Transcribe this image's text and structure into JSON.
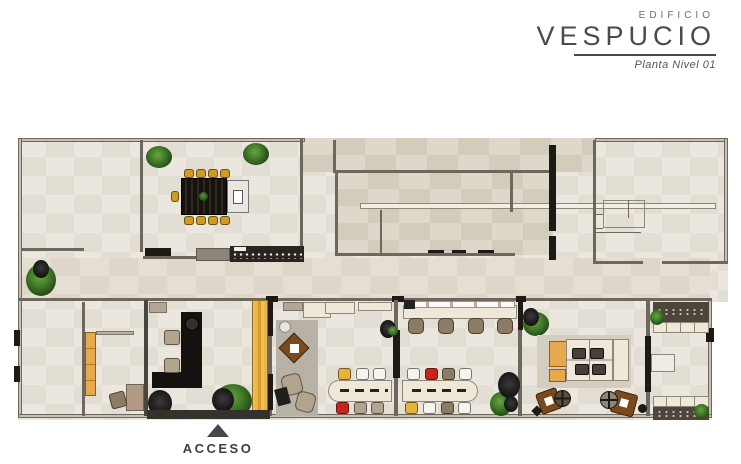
{
  "header": {
    "building_label": "EDIFICIO",
    "building_name": "VESPUCIO",
    "subtitle": "Planta Nivel 01"
  },
  "plan": {
    "access_label": "ACCESO"
  },
  "icons": {
    "access_arrow": "triangle-up-icon",
    "plant": "plant-icon"
  },
  "colors": {
    "floor": "#eae6dd",
    "floorAlt": "#dcd6c7",
    "floorMid": "#e3ddd0",
    "wallFill": "#c6c0b4",
    "wallLine": "#6d675d",
    "black": "#1d1a16",
    "counter": "#4e463c",
    "gold": "#d09b1e",
    "yellow": "#e8b33a",
    "yellowPanel": "#e9b64a",
    "orange": "#e6a94e",
    "red": "#c6251c",
    "cream": "#efe8d8",
    "beige": "#b3a48d",
    "brown": "#7a4a1f",
    "brownChair": "#8d7c64",
    "rug": "#b7b1a8",
    "rugLight": "#d4cdc0",
    "green": "#3f7a28",
    "greenDark": "#1e3a12",
    "titleText": "#4b4b4b",
    "subtitleText": "#555555",
    "accessText": "#3f3f3f"
  }
}
